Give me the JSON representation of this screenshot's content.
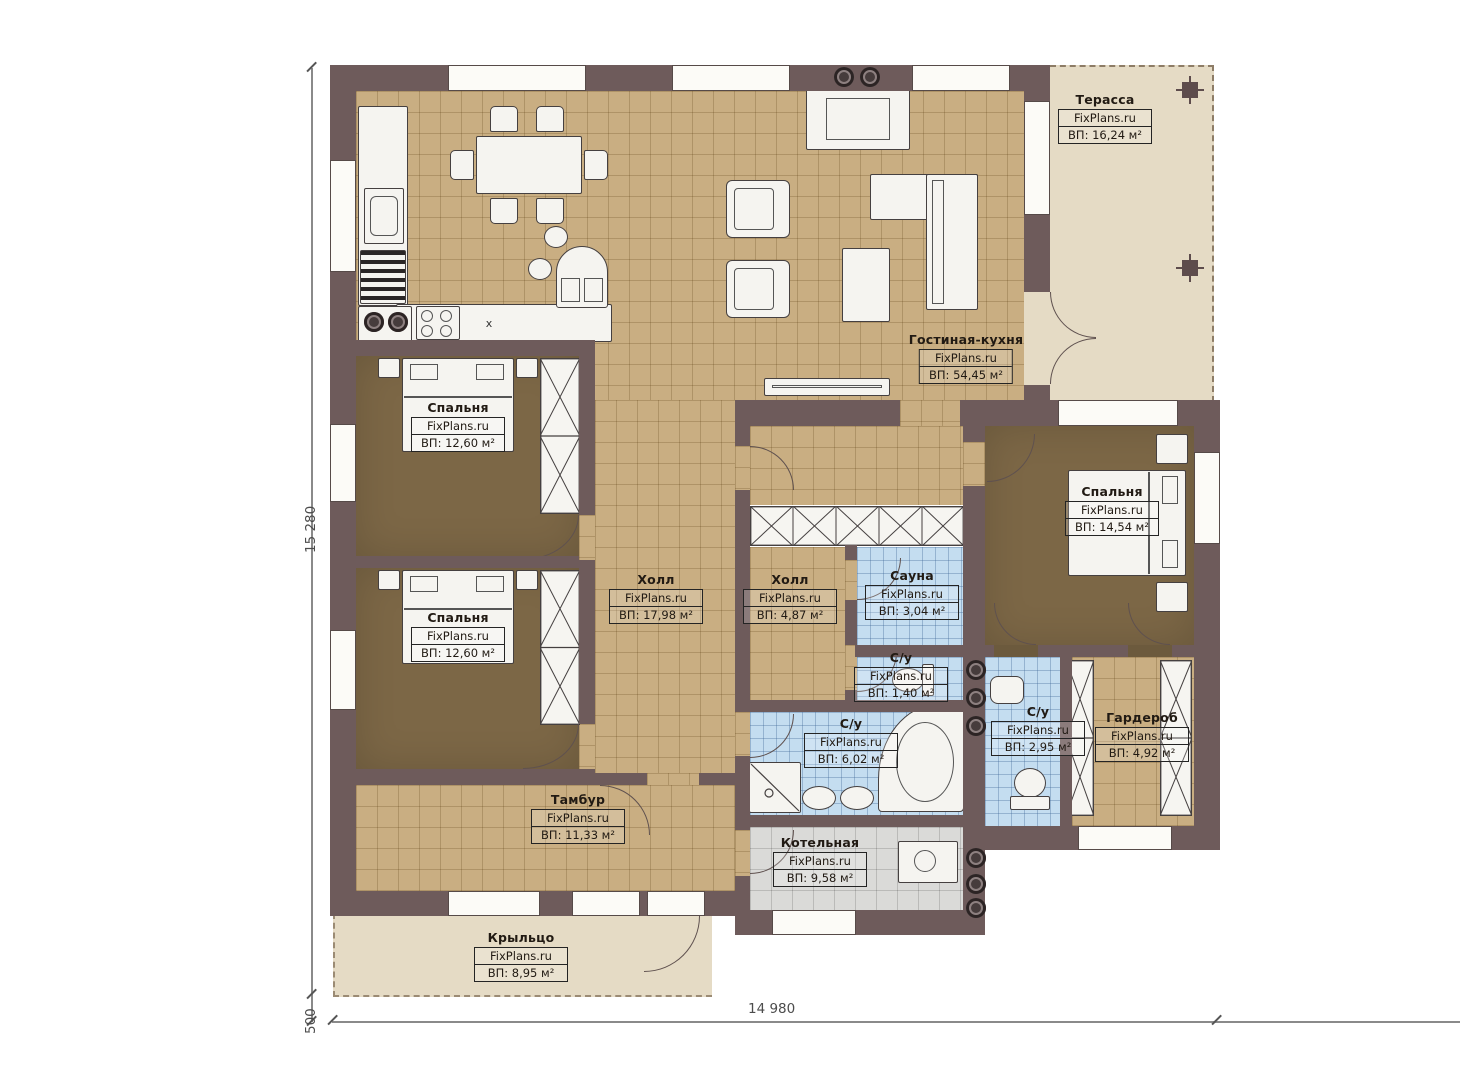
{
  "brand": "FixPlans.ru",
  "rooms": [
    {
      "name": "Терасса",
      "area": "ВП: 16,24 м²"
    },
    {
      "name": "Гостиная-кухня",
      "area": "ВП: 54,45 м²"
    },
    {
      "name": "Спальня",
      "area": "ВП: 12,60 м²"
    },
    {
      "name": "Спальня",
      "area": "ВП: 12,60 м²"
    },
    {
      "name": "Спальня",
      "area": "ВП: 14,54 м²"
    },
    {
      "name": "Холл",
      "area": "ВП: 17,98 м²"
    },
    {
      "name": "Холл",
      "area": "ВП: 4,87 м²"
    },
    {
      "name": "Сауна",
      "area": "ВП: 3,04 м²"
    },
    {
      "name": "С/у",
      "area": "ВП: 1,40 м²"
    },
    {
      "name": "С/у",
      "area": "ВП: 6,02 м²"
    },
    {
      "name": "С/у",
      "area": "ВП: 2,95 м²"
    },
    {
      "name": "Гардероб",
      "area": "ВП: 4,92 м²"
    },
    {
      "name": "Тамбур",
      "area": "ВП: 11,33 м²"
    },
    {
      "name": "Котельная",
      "area": "ВП: 9,58 м²"
    },
    {
      "name": "Крыльцо",
      "area": "ВП: 8,95 м²"
    }
  ],
  "dimensions": {
    "left": "15 280",
    "bottom": "14 980",
    "offset": "500"
  },
  "kitchen": {
    "sink_mark": "x"
  },
  "colors": {
    "wall": "#6e5b5b",
    "tile": "#c9ae82",
    "bedroom": "#7c6746",
    "bath": "#c4ddf0",
    "boiler": "#dadad8",
    "outdoor": "#e5dbc5"
  }
}
